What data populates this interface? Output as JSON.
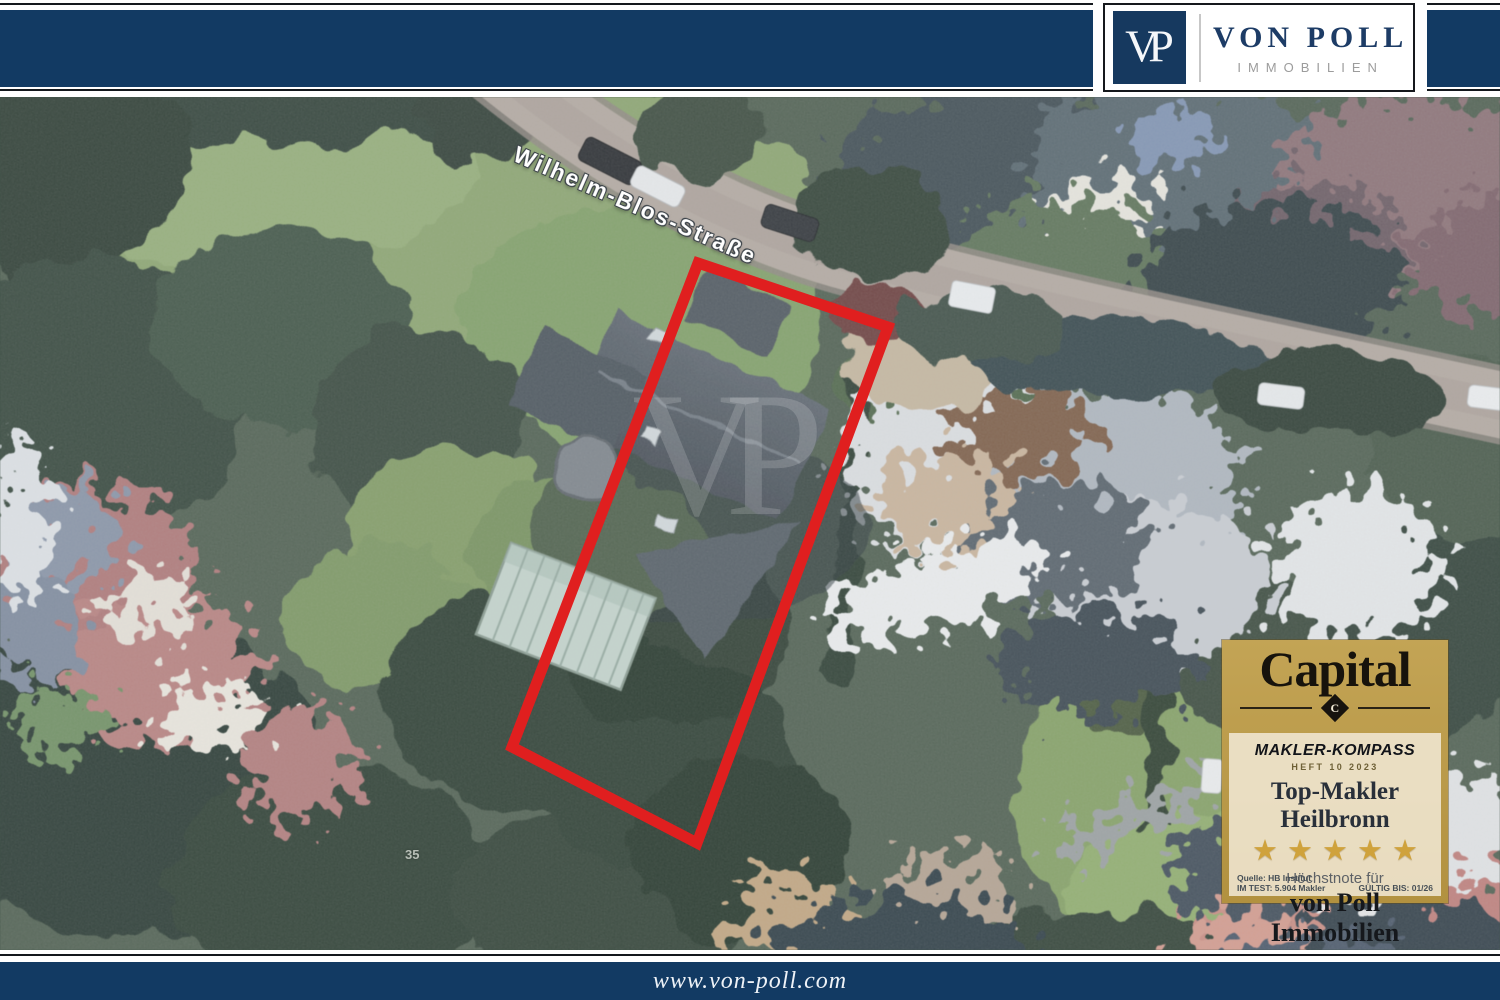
{
  "header": {
    "logo": {
      "monogram": "VP",
      "name": "VON POLL",
      "subtitle": "IMMOBILIEN"
    }
  },
  "map": {
    "street_label": "Wilhelm-Blos-Straße",
    "house_number": "35",
    "watermark": "VP"
  },
  "badge": {
    "brand": "Capital",
    "brand_mark": "C",
    "program": "MAKLER-KOMPASS",
    "issue": "HEFT 10 2023",
    "award": "Top-Makler Heilbronn",
    "rating_stars": 5,
    "star_glyphs": "★★★★★",
    "note_label": "Höchstnote für",
    "recipient": "von Poll Immobilien",
    "source_line1": "Quelle: HB Institut",
    "source_line2": "IM TEST: 5.904 Makler",
    "validity": "GÜLTIG BIS: 01/26"
  },
  "footer": {
    "website": "www.von-poll.com"
  },
  "colors": {
    "navy": "#123a63",
    "gold": "#b6954a",
    "plot_red": "#e01f1f",
    "star_gold": "#cfa23c"
  }
}
